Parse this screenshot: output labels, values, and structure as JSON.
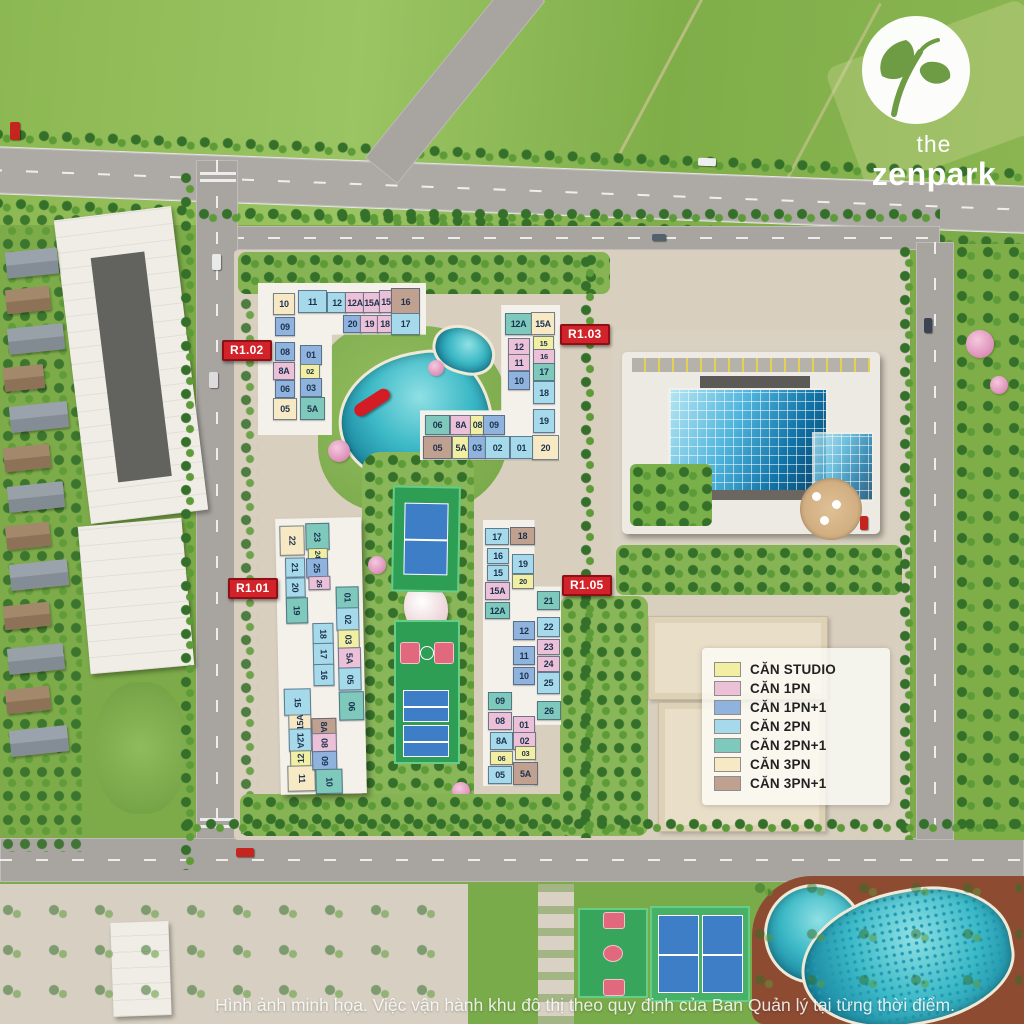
{
  "logo": {
    "the": "the",
    "name": "zenpark"
  },
  "disclaimer": "Hình ảnh minh họa. Việc vận hành khu đô thị theo quy định của Ban Quản lý tại từng thời điểm.",
  "unit_colors": {
    "studio": "#f2efa3",
    "1pn": "#ecc0d6",
    "1pn1": "#8fb3dc",
    "2pn": "#a6d9e9",
    "2pn1": "#7ec9bb",
    "3pn": "#f8e9c5",
    "3pn1": "#c0a08f"
  },
  "badge_color": "#d2232a",
  "legend": {
    "items": [
      {
        "type": "studio",
        "label": "CĂN STUDIO"
      },
      {
        "type": "1pn",
        "label": "CĂN 1PN"
      },
      {
        "type": "1pn1",
        "label": "CĂN 1PN+1"
      },
      {
        "type": "2pn",
        "label": "CĂN 2PN"
      },
      {
        "type": "2pn1",
        "label": "CĂN 2PN+1"
      },
      {
        "type": "3pn",
        "label": "CĂN 3PN"
      },
      {
        "type": "3pn1",
        "label": "CĂN 3PN+1"
      }
    ]
  },
  "buildings": [
    {
      "id": "R1.02",
      "label": "R1.02",
      "cls": "b-r102",
      "x": 258,
      "y": 283,
      "w": 168,
      "h": 152,
      "rot": 0,
      "badge": {
        "x": 222,
        "y": 340
      },
      "units": [
        {
          "id": "10",
          "t": "3pn",
          "x": 15,
          "y": 10,
          "w": 20,
          "h": 20
        },
        {
          "id": "11",
          "t": "2pn",
          "x": 40,
          "y": 7,
          "w": 27,
          "h": 21
        },
        {
          "id": "12",
          "t": "2pn",
          "x": 69,
          "y": 9,
          "w": 18,
          "h": 19
        },
        {
          "id": "12A",
          "t": "1pn",
          "x": 87,
          "y": 9,
          "w": 18,
          "h": 19
        },
        {
          "id": "15A",
          "t": "1pn",
          "x": 105,
          "y": 9,
          "w": 16,
          "h": 19
        },
        {
          "id": "15",
          "t": "1pn",
          "x": 121,
          "y": 7,
          "w": 12,
          "h": 21
        },
        {
          "id": "16",
          "t": "3pn1",
          "x": 133,
          "y": 5,
          "w": 27,
          "h": 25
        },
        {
          "id": "20",
          "t": "1pn1",
          "x": 85,
          "y": 32,
          "w": 17,
          "h": 16
        },
        {
          "id": "19",
          "t": "1pn",
          "x": 102,
          "y": 32,
          "w": 17,
          "h": 16
        },
        {
          "id": "18",
          "t": "1pn",
          "x": 119,
          "y": 32,
          "w": 14,
          "h": 16
        },
        {
          "id": "17",
          "t": "2pn",
          "x": 133,
          "y": 30,
          "w": 27,
          "h": 20
        },
        {
          "id": "09",
          "t": "1pn1",
          "x": 17,
          "y": 34,
          "w": 18,
          "h": 17
        },
        {
          "id": "08",
          "t": "1pn1",
          "x": 17,
          "y": 59,
          "w": 18,
          "h": 17
        },
        {
          "id": "8A",
          "t": "1pn",
          "x": 15,
          "y": 79,
          "w": 20,
          "h": 16
        },
        {
          "id": "06",
          "t": "1pn1",
          "x": 17,
          "y": 97,
          "w": 18,
          "h": 16
        },
        {
          "id": "05",
          "t": "3pn",
          "x": 15,
          "y": 115,
          "w": 22,
          "h": 20
        },
        {
          "id": "01",
          "t": "1pn1",
          "x": 42,
          "y": 62,
          "w": 20,
          "h": 18
        },
        {
          "id": "02",
          "t": "studio",
          "x": 42,
          "y": 81,
          "w": 18,
          "h": 13
        },
        {
          "id": "03",
          "t": "1pn1",
          "x": 42,
          "y": 95,
          "w": 20,
          "h": 17
        },
        {
          "id": "5A",
          "t": "2pn1",
          "x": 42,
          "y": 114,
          "w": 23,
          "h": 21
        }
      ]
    },
    {
      "id": "R1.03",
      "label": "R1.03",
      "cls": "b-r103",
      "x": 420,
      "y": 305,
      "w": 140,
      "h": 155,
      "rot": 0,
      "badge": {
        "x": 560,
        "y": 324
      },
      "units": [
        {
          "id": "12A",
          "t": "2pn1",
          "x": 85,
          "y": 8,
          "w": 25,
          "h": 20
        },
        {
          "id": "15A",
          "t": "3pn",
          "x": 111,
          "y": 7,
          "w": 22,
          "h": 21
        },
        {
          "id": "15",
          "t": "studio",
          "x": 113,
          "y": 31,
          "w": 19,
          "h": 12
        },
        {
          "id": "16",
          "t": "1pn",
          "x": 113,
          "y": 44,
          "w": 20,
          "h": 13
        },
        {
          "id": "17",
          "t": "2pn1",
          "x": 113,
          "y": 58,
          "w": 20,
          "h": 16
        },
        {
          "id": "18",
          "t": "2pn",
          "x": 113,
          "y": 76,
          "w": 20,
          "h": 21
        },
        {
          "id": "19",
          "t": "2pn",
          "x": 113,
          "y": 104,
          "w": 20,
          "h": 22
        },
        {
          "id": "20",
          "t": "3pn",
          "x": 112,
          "y": 130,
          "w": 25,
          "h": 23
        },
        {
          "id": "12",
          "t": "1pn",
          "x": 88,
          "y": 33,
          "w": 20,
          "h": 15
        },
        {
          "id": "11",
          "t": "1pn",
          "x": 88,
          "y": 49,
          "w": 20,
          "h": 15
        },
        {
          "id": "10",
          "t": "1pn1",
          "x": 88,
          "y": 66,
          "w": 20,
          "h": 17
        },
        {
          "id": "06",
          "t": "2pn1",
          "x": 5,
          "y": 110,
          "w": 23,
          "h": 18
        },
        {
          "id": "8A",
          "t": "1pn",
          "x": 30,
          "y": 110,
          "w": 20,
          "h": 18
        },
        {
          "id": "08",
          "t": "studio",
          "x": 50,
          "y": 110,
          "w": 13,
          "h": 18
        },
        {
          "id": "09",
          "t": "1pn1",
          "x": 63,
          "y": 110,
          "w": 20,
          "h": 18
        },
        {
          "id": "05",
          "t": "3pn1",
          "x": 3,
          "y": 131,
          "w": 27,
          "h": 21
        },
        {
          "id": "5A",
          "t": "studio",
          "x": 32,
          "y": 131,
          "w": 16,
          "h": 21
        },
        {
          "id": "03",
          "t": "1pn1",
          "x": 48,
          "y": 131,
          "w": 16,
          "h": 21
        },
        {
          "id": "02",
          "t": "2pn",
          "x": 65,
          "y": 131,
          "w": 23,
          "h": 21
        },
        {
          "id": "01",
          "t": "2pn",
          "x": 90,
          "y": 131,
          "w": 21,
          "h": 21
        }
      ]
    },
    {
      "id": "R1.01",
      "label": "R1.01",
      "cls": "b-r101",
      "x": 278,
      "y": 518,
      "w": 86,
      "h": 276,
      "rot": -1.2,
      "badge": {
        "x": 228,
        "y": 578
      },
      "units": [
        {
          "id": "22",
          "t": "3pn",
          "x": 4,
          "y": 7,
          "w": 23,
          "h": 28
        },
        {
          "id": "23",
          "t": "2pn1",
          "x": 30,
          "y": 5,
          "w": 22,
          "h": 25
        },
        {
          "id": "24",
          "t": "studio",
          "x": 32,
          "y": 30,
          "w": 18,
          "h": 10
        },
        {
          "id": "25",
          "t": "1pn1",
          "x": 30,
          "y": 40,
          "w": 20,
          "h": 18
        },
        {
          "id": "26",
          "t": "1pn",
          "x": 32,
          "y": 58,
          "w": 20,
          "h": 12
        },
        {
          "id": "21",
          "t": "2pn",
          "x": 9,
          "y": 39,
          "w": 18,
          "h": 18
        },
        {
          "id": "20",
          "t": "2pn",
          "x": 9,
          "y": 59,
          "w": 18,
          "h": 18
        },
        {
          "id": "19",
          "t": "2pn1",
          "x": 9,
          "y": 79,
          "w": 20,
          "h": 24
        },
        {
          "id": "01",
          "t": "2pn1",
          "x": 59,
          "y": 69,
          "w": 21,
          "h": 20
        },
        {
          "id": "02",
          "t": "2pn",
          "x": 59,
          "y": 90,
          "w": 21,
          "h": 21
        },
        {
          "id": "03",
          "t": "studio",
          "x": 60,
          "y": 112,
          "w": 20,
          "h": 17
        },
        {
          "id": "5A",
          "t": "1pn",
          "x": 60,
          "y": 130,
          "w": 21,
          "h": 19
        },
        {
          "id": "05",
          "t": "2pn",
          "x": 60,
          "y": 150,
          "w": 21,
          "h": 21
        },
        {
          "id": "06",
          "t": "2pn1",
          "x": 60,
          "y": 174,
          "w": 23,
          "h": 27
        },
        {
          "id": "18",
          "t": "2pn",
          "x": 35,
          "y": 105,
          "w": 19,
          "h": 19
        },
        {
          "id": "17",
          "t": "2pn",
          "x": 35,
          "y": 125,
          "w": 19,
          "h": 20
        },
        {
          "id": "16",
          "t": "2pn",
          "x": 35,
          "y": 146,
          "w": 19,
          "h": 20
        },
        {
          "id": "15",
          "t": "2pn",
          "x": 5,
          "y": 170,
          "w": 25,
          "h": 25
        },
        {
          "id": "15A",
          "t": "3pn",
          "x": 9,
          "y": 196,
          "w": 21,
          "h": 14,
          "r": -90
        },
        {
          "id": "12A",
          "t": "2pn",
          "x": 9,
          "y": 210,
          "w": 21,
          "h": 21
        },
        {
          "id": "12",
          "t": "studio",
          "x": 10,
          "y": 232,
          "w": 19,
          "h": 14,
          "r": -90
        },
        {
          "id": "11",
          "t": "3pn",
          "x": 7,
          "y": 247,
          "w": 26,
          "h": 24
        },
        {
          "id": "8A",
          "t": "3pn1",
          "x": 32,
          "y": 200,
          "w": 23,
          "h": 15
        },
        {
          "id": "08",
          "t": "1pn",
          "x": 32,
          "y": 215,
          "w": 23,
          "h": 18
        },
        {
          "id": "09",
          "t": "1pn1",
          "x": 32,
          "y": 233,
          "w": 23,
          "h": 17
        },
        {
          "id": "10",
          "t": "2pn1",
          "x": 35,
          "y": 251,
          "w": 25,
          "h": 23
        }
      ]
    },
    {
      "id": "R1.05",
      "label": "R1.05",
      "cls": "b-r105",
      "x": 483,
      "y": 520,
      "w": 78,
      "h": 266,
      "rot": 0,
      "badge": {
        "x": 562,
        "y": 575
      },
      "units": [
        {
          "id": "17",
          "t": "2pn",
          "x": 2,
          "y": 8,
          "w": 22,
          "h": 15
        },
        {
          "id": "16",
          "t": "2pn",
          "x": 4,
          "y": 28,
          "w": 20,
          "h": 14
        },
        {
          "id": "15",
          "t": "2pn",
          "x": 4,
          "y": 45,
          "w": 20,
          "h": 14
        },
        {
          "id": "15A",
          "t": "1pn",
          "x": 2,
          "y": 62,
          "w": 23,
          "h": 16
        },
        {
          "id": "12A",
          "t": "2pn1",
          "x": 2,
          "y": 82,
          "w": 23,
          "h": 15
        },
        {
          "id": "18",
          "t": "3pn1",
          "x": 27,
          "y": 7,
          "w": 23,
          "h": 16
        },
        {
          "id": "19",
          "t": "2pn",
          "x": 29,
          "y": 34,
          "w": 20,
          "h": 18
        },
        {
          "id": "20",
          "t": "studio",
          "x": 29,
          "y": 54,
          "w": 20,
          "h": 13
        },
        {
          "id": "12",
          "t": "1pn1",
          "x": 30,
          "y": 101,
          "w": 20,
          "h": 17
        },
        {
          "id": "11",
          "t": "1pn1",
          "x": 30,
          "y": 126,
          "w": 20,
          "h": 17
        },
        {
          "id": "10",
          "t": "1pn1",
          "x": 30,
          "y": 147,
          "w": 20,
          "h": 16
        },
        {
          "id": "21",
          "t": "2pn1",
          "x": 54,
          "y": 71,
          "w": 21,
          "h": 17
        },
        {
          "id": "22",
          "t": "2pn",
          "x": 54,
          "y": 97,
          "w": 21,
          "h": 18
        },
        {
          "id": "23",
          "t": "1pn",
          "x": 54,
          "y": 119,
          "w": 21,
          "h": 14
        },
        {
          "id": "24",
          "t": "1pn",
          "x": 54,
          "y": 136,
          "w": 21,
          "h": 14
        },
        {
          "id": "25",
          "t": "2pn",
          "x": 54,
          "y": 152,
          "w": 21,
          "h": 20
        },
        {
          "id": "26",
          "t": "2pn1",
          "x": 54,
          "y": 181,
          "w": 22,
          "h": 17
        },
        {
          "id": "09",
          "t": "2pn1",
          "x": 5,
          "y": 172,
          "w": 22,
          "h": 16
        },
        {
          "id": "08",
          "t": "1pn",
          "x": 5,
          "y": 192,
          "w": 22,
          "h": 16
        },
        {
          "id": "8A",
          "t": "2pn",
          "x": 7,
          "y": 212,
          "w": 21,
          "h": 16
        },
        {
          "id": "06",
          "t": "studio",
          "x": 7,
          "y": 231,
          "w": 21,
          "h": 12
        },
        {
          "id": "05",
          "t": "2pn",
          "x": 5,
          "y": 246,
          "w": 22,
          "h": 16
        },
        {
          "id": "01",
          "t": "1pn",
          "x": 30,
          "y": 196,
          "w": 20,
          "h": 16
        },
        {
          "id": "02",
          "t": "1pn",
          "x": 30,
          "y": 212,
          "w": 21,
          "h": 16
        },
        {
          "id": "03",
          "t": "studio",
          "x": 32,
          "y": 226,
          "w": 19,
          "h": 12
        },
        {
          "id": "5A",
          "t": "3pn1",
          "x": 30,
          "y": 242,
          "w": 23,
          "h": 21
        }
      ]
    }
  ]
}
